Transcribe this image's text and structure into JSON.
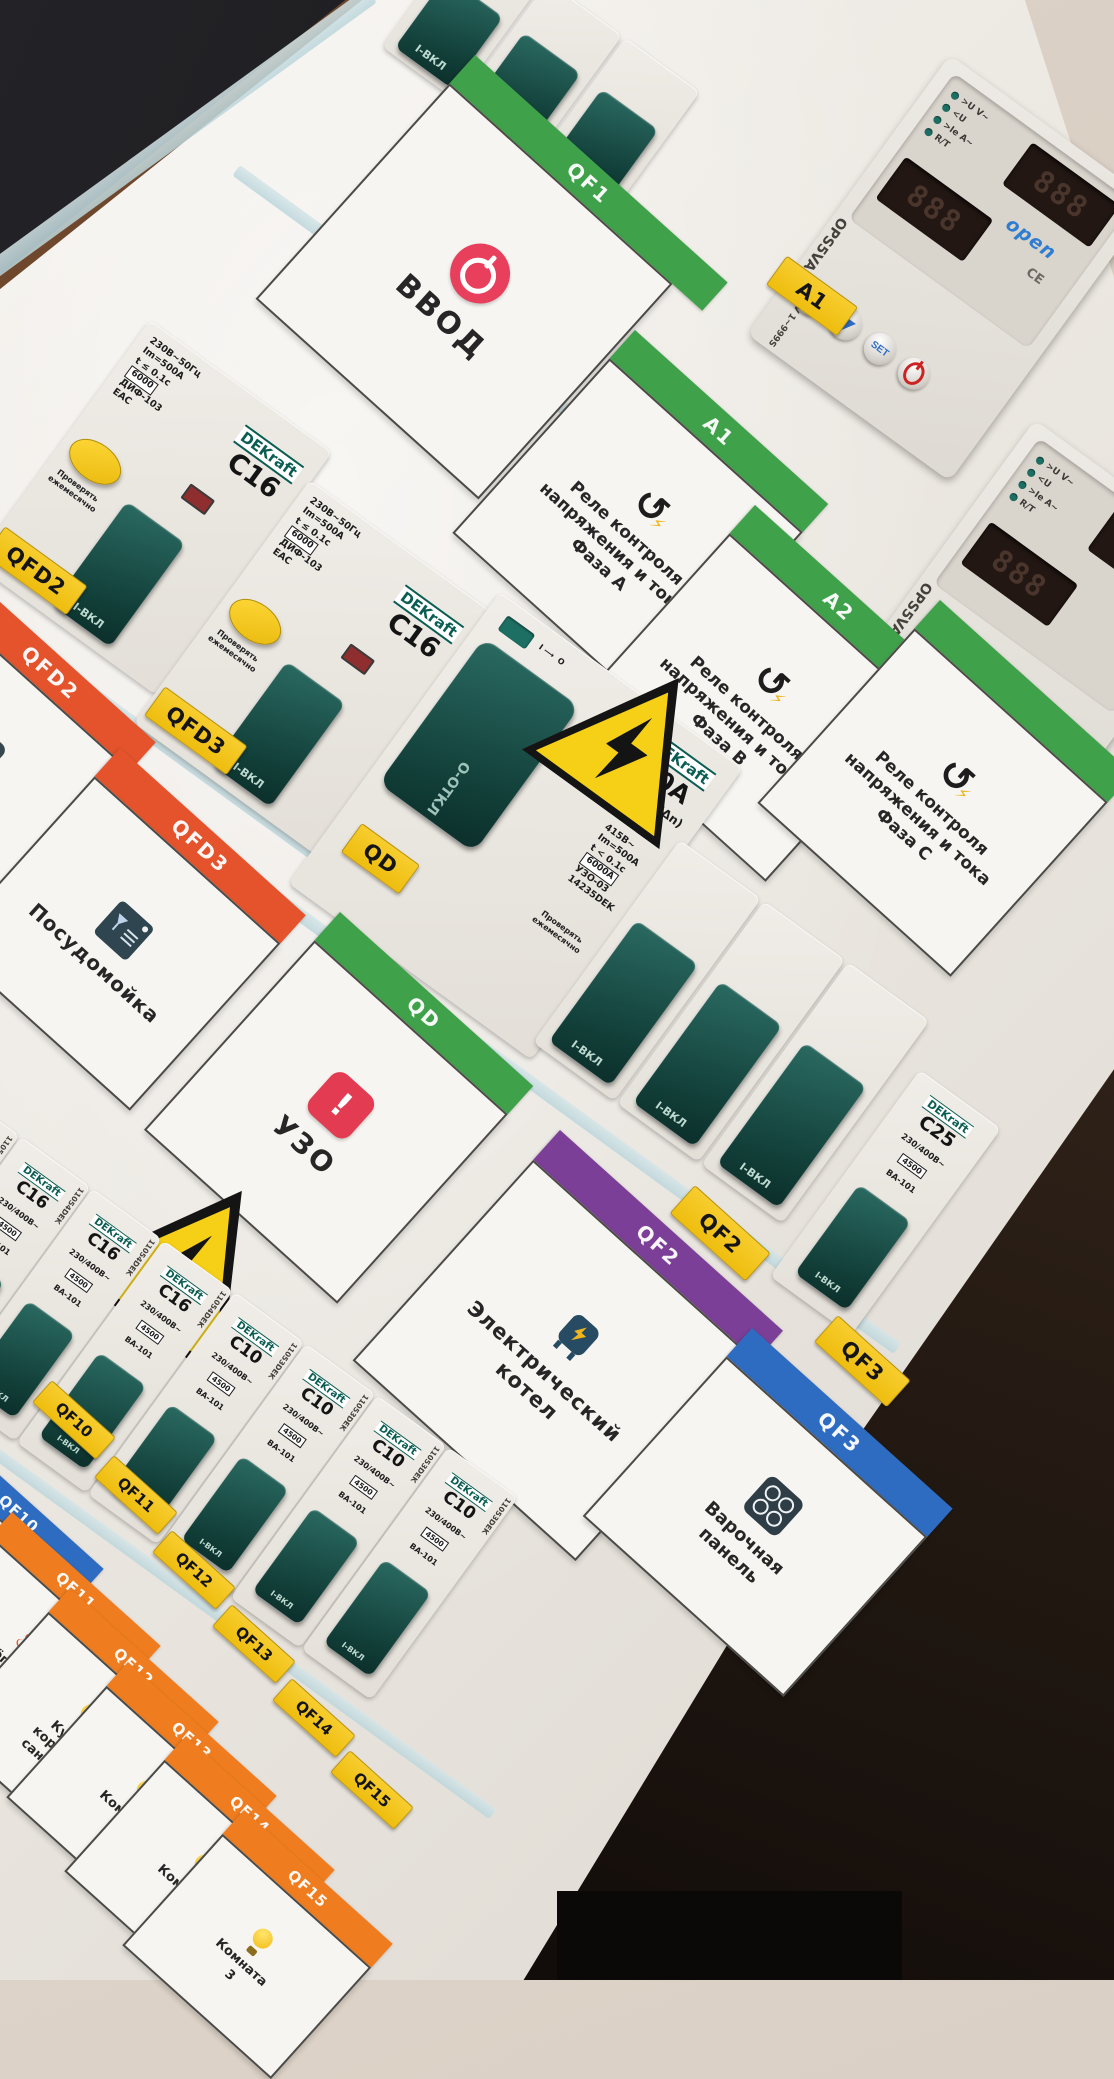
{
  "scene": {
    "description": "Tilted photo of apartment electrical distribution board",
    "wall_color": "#d8cec4",
    "floor_color": "#2a1f18",
    "panel_color": "#efece7",
    "sticker_color": "#f3c51a",
    "green": "#3fa24a",
    "orange_red": "#e4532c",
    "orange": "#ef7d1f",
    "purple": "#7c3f97",
    "blue": "#2e6cc2"
  },
  "brands": {
    "dekraft": "DEKraft"
  },
  "labels": {
    "toggle_on": "I-ВКЛ",
    "test_note_1": "Проверять",
    "test_note_2": "ежемесячно"
  },
  "circuits": {
    "qf1": {
      "sticker": "QF1",
      "band": "QF1",
      "label": "ВВОД",
      "icon": "power-icon"
    },
    "a1": {
      "sticker": "A1",
      "band": "A1",
      "lines": [
        "Реле контроля",
        "напряжения и тока",
        "Фаза А"
      ],
      "icon": "recycle-icon"
    },
    "a2": {
      "sticker": "A2",
      "band": "A2",
      "lines": [
        "Реле контроля",
        "напряжения и тока",
        "Фаза В"
      ],
      "icon": "recycle-icon"
    },
    "a3": {
      "band": "",
      "lines": [
        "Реле контроля",
        "напряжения и тока",
        "Фаза С"
      ],
      "icon": "recycle-icon"
    },
    "qfd2": {
      "sticker": "QFD2",
      "band": "QFD2",
      "label": "Бойлер",
      "icon": "boiler-icon"
    },
    "qfd3": {
      "sticker": "QFD3",
      "band": "QFD3",
      "label": "Посудомойка",
      "icon": "dishwasher-icon"
    },
    "qd": {
      "sticker": "QD",
      "band": "QD",
      "label": "УЗО",
      "icon": "alert-icon"
    },
    "qf2": {
      "sticker": "QF2",
      "band": "QF2",
      "lines": [
        "Электрический",
        "котел"
      ],
      "icon": "electric-boiler-icon"
    },
    "qf3": {
      "sticker": "QF3",
      "band": "QF3",
      "lines": [
        "Варочная",
        "панель"
      ],
      "icon": "cooktop-icon"
    },
    "qf10": {
      "sticker": "QF10",
      "band": "QF10",
      "icon": "snowflake-icon"
    },
    "qf11": {
      "sticker": "QF11",
      "band": "QF11",
      "lines": [
        "Тёплый",
        "пол"
      ],
      "icon": "heat-icon"
    },
    "qf12": {
      "sticker": "QF12",
      "band": "QF12",
      "lines": [
        "Кухня",
        "коридор",
        "сан.узел"
      ],
      "icon": "bulb-icon"
    },
    "qf13": {
      "sticker": "QF13",
      "band": "QF13",
      "lines": [
        "Комната",
        "1"
      ],
      "icon": "bulb-icon"
    },
    "qf14": {
      "sticker": "QF14",
      "band": "QF14",
      "lines": [
        "Комната",
        "2"
      ],
      "icon": "bulb-icon"
    },
    "qf15": {
      "sticker": "QF15",
      "band": "QF15",
      "lines": [
        "Комната",
        "3"
      ],
      "icon": "bulb-icon"
    }
  },
  "breakers": {
    "dif": {
      "rating": "C16",
      "specs": [
        "230В~50Гц",
        "Im=500A",
        "t ≤ 0.1с"
      ],
      "box": "6000",
      "model": "ДИФ-103",
      "cert": "ЕАС"
    },
    "uzo": {
      "rating": "40A",
      "residual": "30mA (IΔn)",
      "specs": [
        "415В~",
        "Im=500A",
        "t < 0.1с"
      ],
      "box": "6000A",
      "model": "УЗО-03",
      "article": "14235DEK",
      "off_label": "О-ОТКЛ"
    },
    "c25": {
      "rating": "C25",
      "voltage": "230/400В~",
      "box": "4500",
      "model": "ВА-101"
    },
    "bottom_shared": {
      "voltage": "230/400В~",
      "box": "4500",
      "model": "ВА-101"
    },
    "bottom_row": [
      {
        "rating": "C16",
        "article": "11054DEK"
      },
      {
        "rating": "C16",
        "article": "11054DEK"
      },
      {
        "rating": "C16",
        "article": "11054DEK"
      },
      {
        "rating": "C16",
        "article": "11054DEK"
      },
      {
        "rating": "C10",
        "article": "11053DEK"
      },
      {
        "rating": "C10",
        "article": "11053DEK"
      },
      {
        "rating": "C10",
        "article": "11053DEK"
      },
      {
        "rating": "C10",
        "article": "11053DEK"
      }
    ]
  },
  "relay": {
    "model": "OPS5VA-40",
    "logo": "open",
    "ce": "CE",
    "set": "SET",
    "range": "-300V 1~999S",
    "leds": [
      ">U V~",
      "<U",
      ">Ie A~",
      "R/T"
    ],
    "display_1": "888",
    "display_2": "888"
  }
}
